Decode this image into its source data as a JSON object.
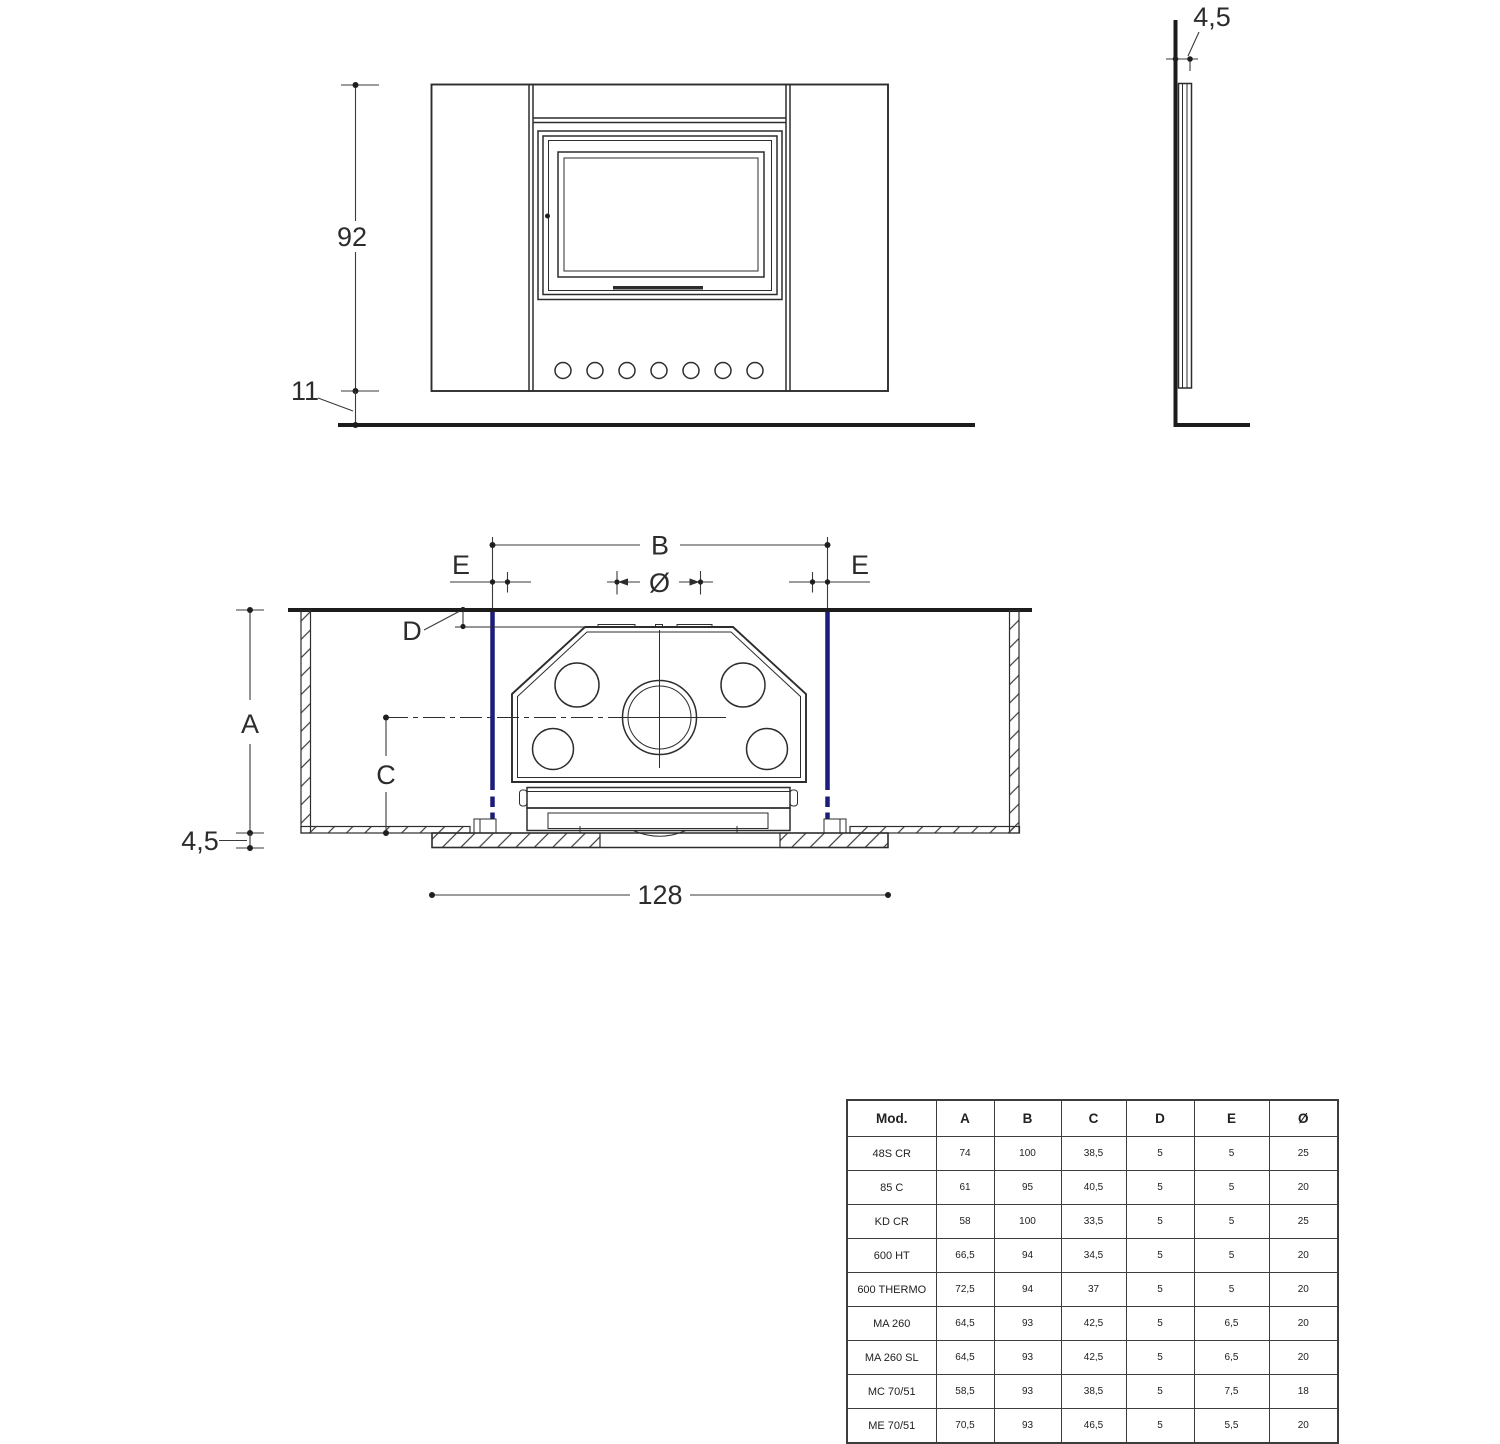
{
  "drawing": {
    "line_color": "#2d2d2d",
    "accent_blue": "#1c1c7a",
    "front_view": {
      "height": "92",
      "plinth": "11"
    },
    "side_view": {
      "thickness": "4,5"
    },
    "plan_view": {
      "b": "B",
      "e_left": "E",
      "e_right": "E",
      "diameter": "Ø",
      "d": "D",
      "a": "A",
      "c": "C",
      "wall_thickness": "4,5",
      "width": "128"
    }
  },
  "spec_table": {
    "columns": [
      "Mod.",
      "A",
      "B",
      "C",
      "D",
      "E",
      "Ø"
    ],
    "rows": [
      [
        "48S CR",
        "74",
        "100",
        "38,5",
        "5",
        "5",
        "25"
      ],
      [
        "85 C",
        "61",
        "95",
        "40,5",
        "5",
        "5",
        "20"
      ],
      [
        "KD CR",
        "58",
        "100",
        "33,5",
        "5",
        "5",
        "25"
      ],
      [
        "600 HT",
        "66,5",
        "94",
        "34,5",
        "5",
        "5",
        "20"
      ],
      [
        "600 THERMO",
        "72,5",
        "94",
        "37",
        "5",
        "5",
        "20"
      ],
      [
        "MA 260",
        "64,5",
        "93",
        "42,5",
        "5",
        "6,5",
        "20"
      ],
      [
        "MA 260 SL",
        "64,5",
        "93",
        "42,5",
        "5",
        "6,5",
        "20"
      ],
      [
        "MC 70/51",
        "58,5",
        "93",
        "38,5",
        "5",
        "7,5",
        "18"
      ],
      [
        "ME 70/51",
        "70,5",
        "93",
        "46,5",
        "5",
        "5,5",
        "20"
      ]
    ]
  }
}
